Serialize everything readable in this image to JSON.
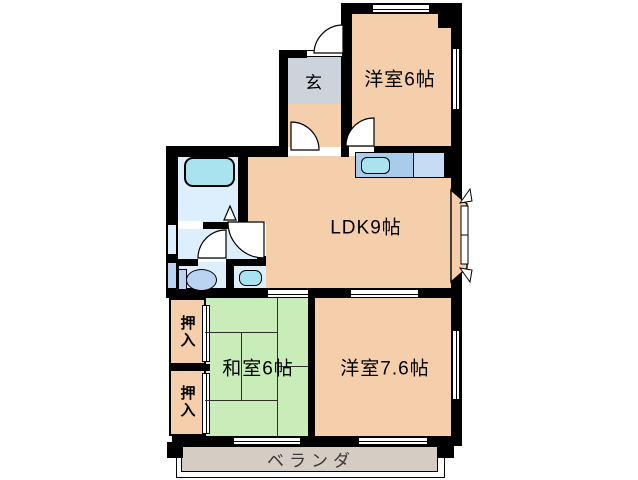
{
  "plan_title": "apartment-floorplan",
  "rooms": {
    "genkan": {
      "label": "玄"
    },
    "western6": {
      "label": "洋室6帖"
    },
    "ldk": {
      "label": "LDK9帖"
    },
    "japanese6": {
      "label": "和室6帖"
    },
    "western76": {
      "label": "洋室7.6帖"
    },
    "closet_upper": {
      "label": "押入"
    },
    "closet_lower": {
      "label": "押入"
    },
    "veranda": {
      "label": "ベランダ"
    }
  },
  "fixtures": {
    "bathtub": "bathtub-icon",
    "kitchen_sink": "kitchen-sink-icon",
    "toilet": "toilet-icon",
    "washbasin": "washbasin-icon",
    "bay_window": "bay-window-icon",
    "doors": "door-swing-arc-icon",
    "windows": "sliding-window-icon",
    "closet_doors": "fusuma-door-icon"
  },
  "colors": {
    "walls": "#000000",
    "room_floor_peach": "#f5cfab",
    "entry_gray": "#ccd3da",
    "wet_area_blue": "#ddeefc",
    "tub_cyan": "#a9e3f0",
    "counter_blue": "#a9cbec",
    "counter_blue_light": "#c6dcf4",
    "fixture_blue": "#b9d3f0",
    "tatami_green": "#c9edb9",
    "veranda_tan": "#d5ccc3"
  }
}
